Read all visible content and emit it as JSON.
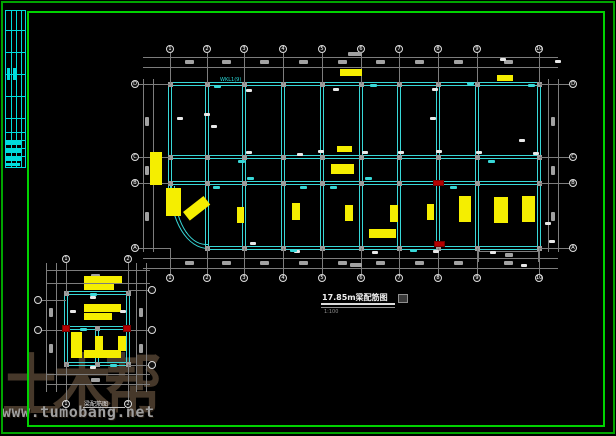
{
  "page": {
    "bg": "#000000",
    "outer_border_color": "#00a400",
    "inner_border_color": "#00d200"
  },
  "watermark": {
    "brand": "土木帮",
    "url": "www.tumobang.net",
    "brand_color": "#46382a",
    "url_color": "#9f9f9f"
  },
  "title_block": {
    "line_color": "#00dcdc",
    "x": 5,
    "y": 10,
    "w": 21,
    "h": 158,
    "col_lines_x": [
      11,
      16,
      21
    ],
    "row_lines_y": [
      30,
      52,
      74,
      96,
      118,
      132,
      140,
      148,
      156
    ],
    "text_marks": [
      [
        7,
        68,
        3,
        12
      ],
      [
        13,
        68,
        3,
        12
      ],
      [
        6,
        141,
        16,
        4
      ],
      [
        6,
        149,
        16,
        4
      ],
      [
        6,
        157,
        16,
        4
      ],
      [
        6,
        163,
        14,
        3
      ]
    ]
  },
  "main_plan": {
    "title": "17.85m梁配筋图",
    "scale_note": "1:100",
    "beam_label": "WKL1(9)",
    "beam_color": "#38d8d8",
    "dim_color": "#7d7d7d",
    "blob_color": "#a2a2a2",
    "axis_x": [
      170,
      207,
      244,
      283,
      322,
      361,
      399,
      438,
      477,
      539
    ],
    "axis_y": [
      84,
      157,
      183,
      248
    ],
    "top_axis_labels": [
      "1",
      "2",
      "3",
      "4",
      "5",
      "6",
      "7",
      "8",
      "9",
      "10"
    ],
    "bottom_axis_labels": [
      "1",
      "2",
      "3",
      "4",
      "5",
      "6",
      "7",
      "8",
      "9",
      "10"
    ],
    "left_axis_labels": [
      "D",
      "C",
      "B",
      "A"
    ],
    "right_axis_labels": [
      "D",
      "C",
      "B",
      "A"
    ]
  },
  "small_plan": {
    "title": "梁配筋图",
    "axis_x": [
      66,
      128
    ],
    "axis_y_rows": [
      293,
      328,
      364
    ],
    "top_axis_labels": [
      "1",
      "2"
    ],
    "bottom_axis_labels": [
      "1",
      "2"
    ]
  },
  "annotations": {
    "yellow_color": "#f5ee00",
    "red_color": "#b40000",
    "yellow_main": [
      [
        340,
        69,
        22,
        7,
        0
      ],
      [
        497,
        75,
        16,
        6,
        0
      ],
      [
        150,
        152,
        12,
        33,
        0
      ],
      [
        166,
        188,
        15,
        28,
        0
      ],
      [
        183,
        212,
        26,
        11,
        -38
      ],
      [
        337,
        146,
        15,
        6,
        0
      ],
      [
        331,
        164,
        23,
        10,
        0
      ],
      [
        237,
        207,
        7,
        16,
        0
      ],
      [
        292,
        203,
        8,
        17,
        0
      ],
      [
        345,
        205,
        8,
        16,
        0
      ],
      [
        390,
        205,
        8,
        17,
        0
      ],
      [
        427,
        204,
        7,
        16,
        0
      ],
      [
        459,
        196,
        12,
        26,
        0
      ],
      [
        494,
        197,
        14,
        26,
        0
      ],
      [
        522,
        196,
        13,
        26,
        0
      ],
      [
        369,
        229,
        27,
        9,
        0
      ]
    ],
    "red_main": [
      [
        433,
        180,
        11,
        6
      ],
      [
        434,
        241,
        11,
        6
      ]
    ],
    "white_main": [
      [
        177,
        117
      ],
      [
        204,
        113
      ],
      [
        211,
        125
      ],
      [
        246,
        151
      ],
      [
        297,
        153
      ],
      [
        318,
        150
      ],
      [
        362,
        151
      ],
      [
        398,
        151
      ],
      [
        436,
        150
      ],
      [
        476,
        151
      ],
      [
        519,
        139
      ],
      [
        533,
        152
      ],
      [
        430,
        117
      ],
      [
        500,
        58
      ],
      [
        246,
        89
      ],
      [
        333,
        88
      ],
      [
        432,
        88
      ],
      [
        250,
        242
      ],
      [
        294,
        250
      ],
      [
        372,
        251
      ],
      [
        433,
        250
      ],
      [
        490,
        251
      ],
      [
        521,
        264
      ],
      [
        549,
        240
      ],
      [
        545,
        222
      ],
      [
        148,
        289
      ],
      [
        555,
        60
      ]
    ],
    "cyan_main": [
      [
        247,
        177
      ],
      [
        365,
        177
      ],
      [
        467,
        82
      ],
      [
        370,
        84
      ],
      [
        214,
        85
      ],
      [
        290,
        249
      ],
      [
        410,
        249
      ],
      [
        488,
        160
      ],
      [
        213,
        186
      ],
      [
        330,
        186
      ],
      [
        450,
        186
      ],
      [
        528,
        84
      ],
      [
        238,
        160
      ],
      [
        300,
        186
      ]
    ],
    "yellow_small": [
      [
        84,
        276,
        38,
        7,
        0
      ],
      [
        84,
        284,
        30,
        6,
        0
      ],
      [
        84,
        304,
        37,
        8,
        0
      ],
      [
        84,
        313,
        28,
        7,
        0
      ],
      [
        71,
        332,
        11,
        26,
        0
      ],
      [
        95,
        336,
        8,
        20,
        0
      ],
      [
        118,
        336,
        8,
        15,
        0
      ],
      [
        84,
        350,
        37,
        8,
        0
      ]
    ],
    "red_small": [
      [
        62,
        325,
        8,
        7
      ],
      [
        123,
        325,
        8,
        7
      ]
    ],
    "white_small": [
      [
        90,
        296
      ],
      [
        70,
        310
      ],
      [
        120,
        310
      ],
      [
        90,
        366
      ]
    ],
    "cyan_small": [
      [
        90,
        293
      ],
      [
        110,
        364
      ],
      [
        80,
        328
      ]
    ]
  }
}
